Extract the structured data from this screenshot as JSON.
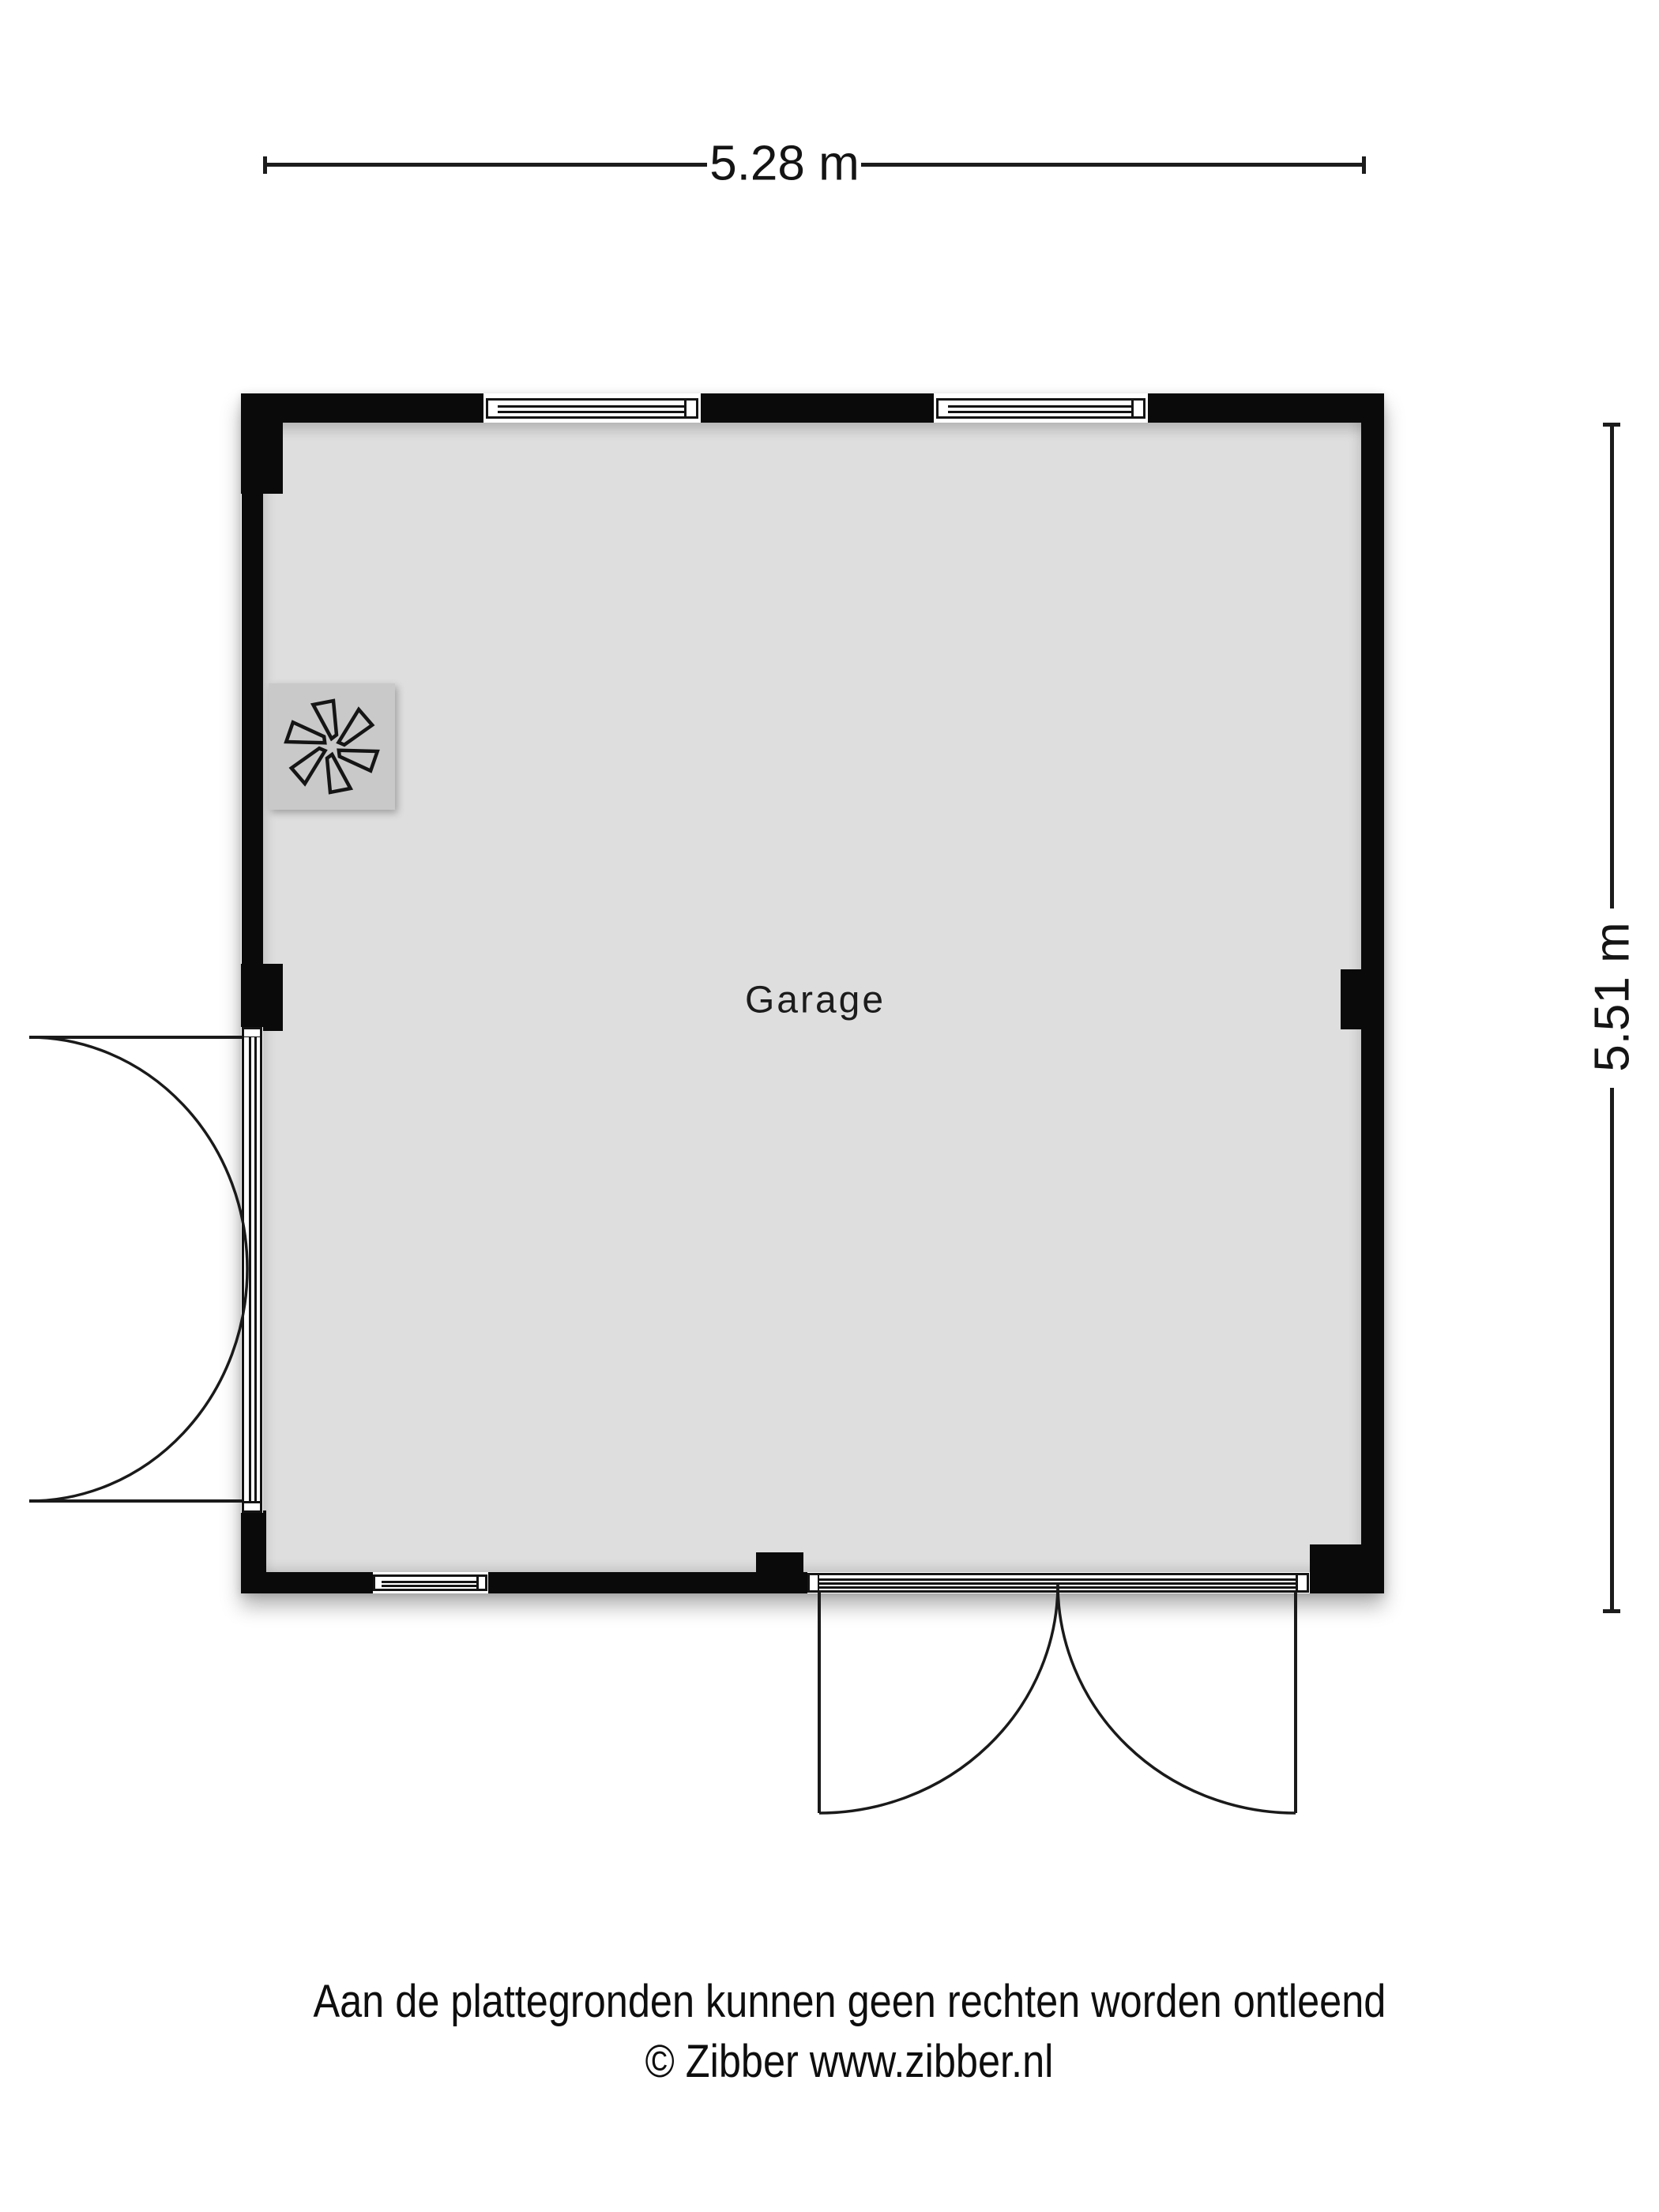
{
  "plan": {
    "room_label": "Garage",
    "dimensions": {
      "width_label": "5.28 m",
      "height_label": "5.51 m"
    },
    "features": {
      "windows": [
        "top-wall-window-left",
        "top-wall-window-right",
        "bottom-wall-window"
      ],
      "doors": [
        "left-double-door-outward",
        "bottom-double-door-outward"
      ],
      "icons": [
        {
          "name": "fan-icon",
          "meaning": "ventilation fan unit"
        }
      ]
    },
    "colors": {
      "wall": "#0a0a0a",
      "floor": "#dedede",
      "fan_square": "#c9c9c9",
      "background": "#ffffff"
    }
  },
  "footer": {
    "disclaimer": "Aan de plattegronden kunnen geen rechten worden ontleend",
    "copyright": "© Zibber www.zibber.nl"
  }
}
